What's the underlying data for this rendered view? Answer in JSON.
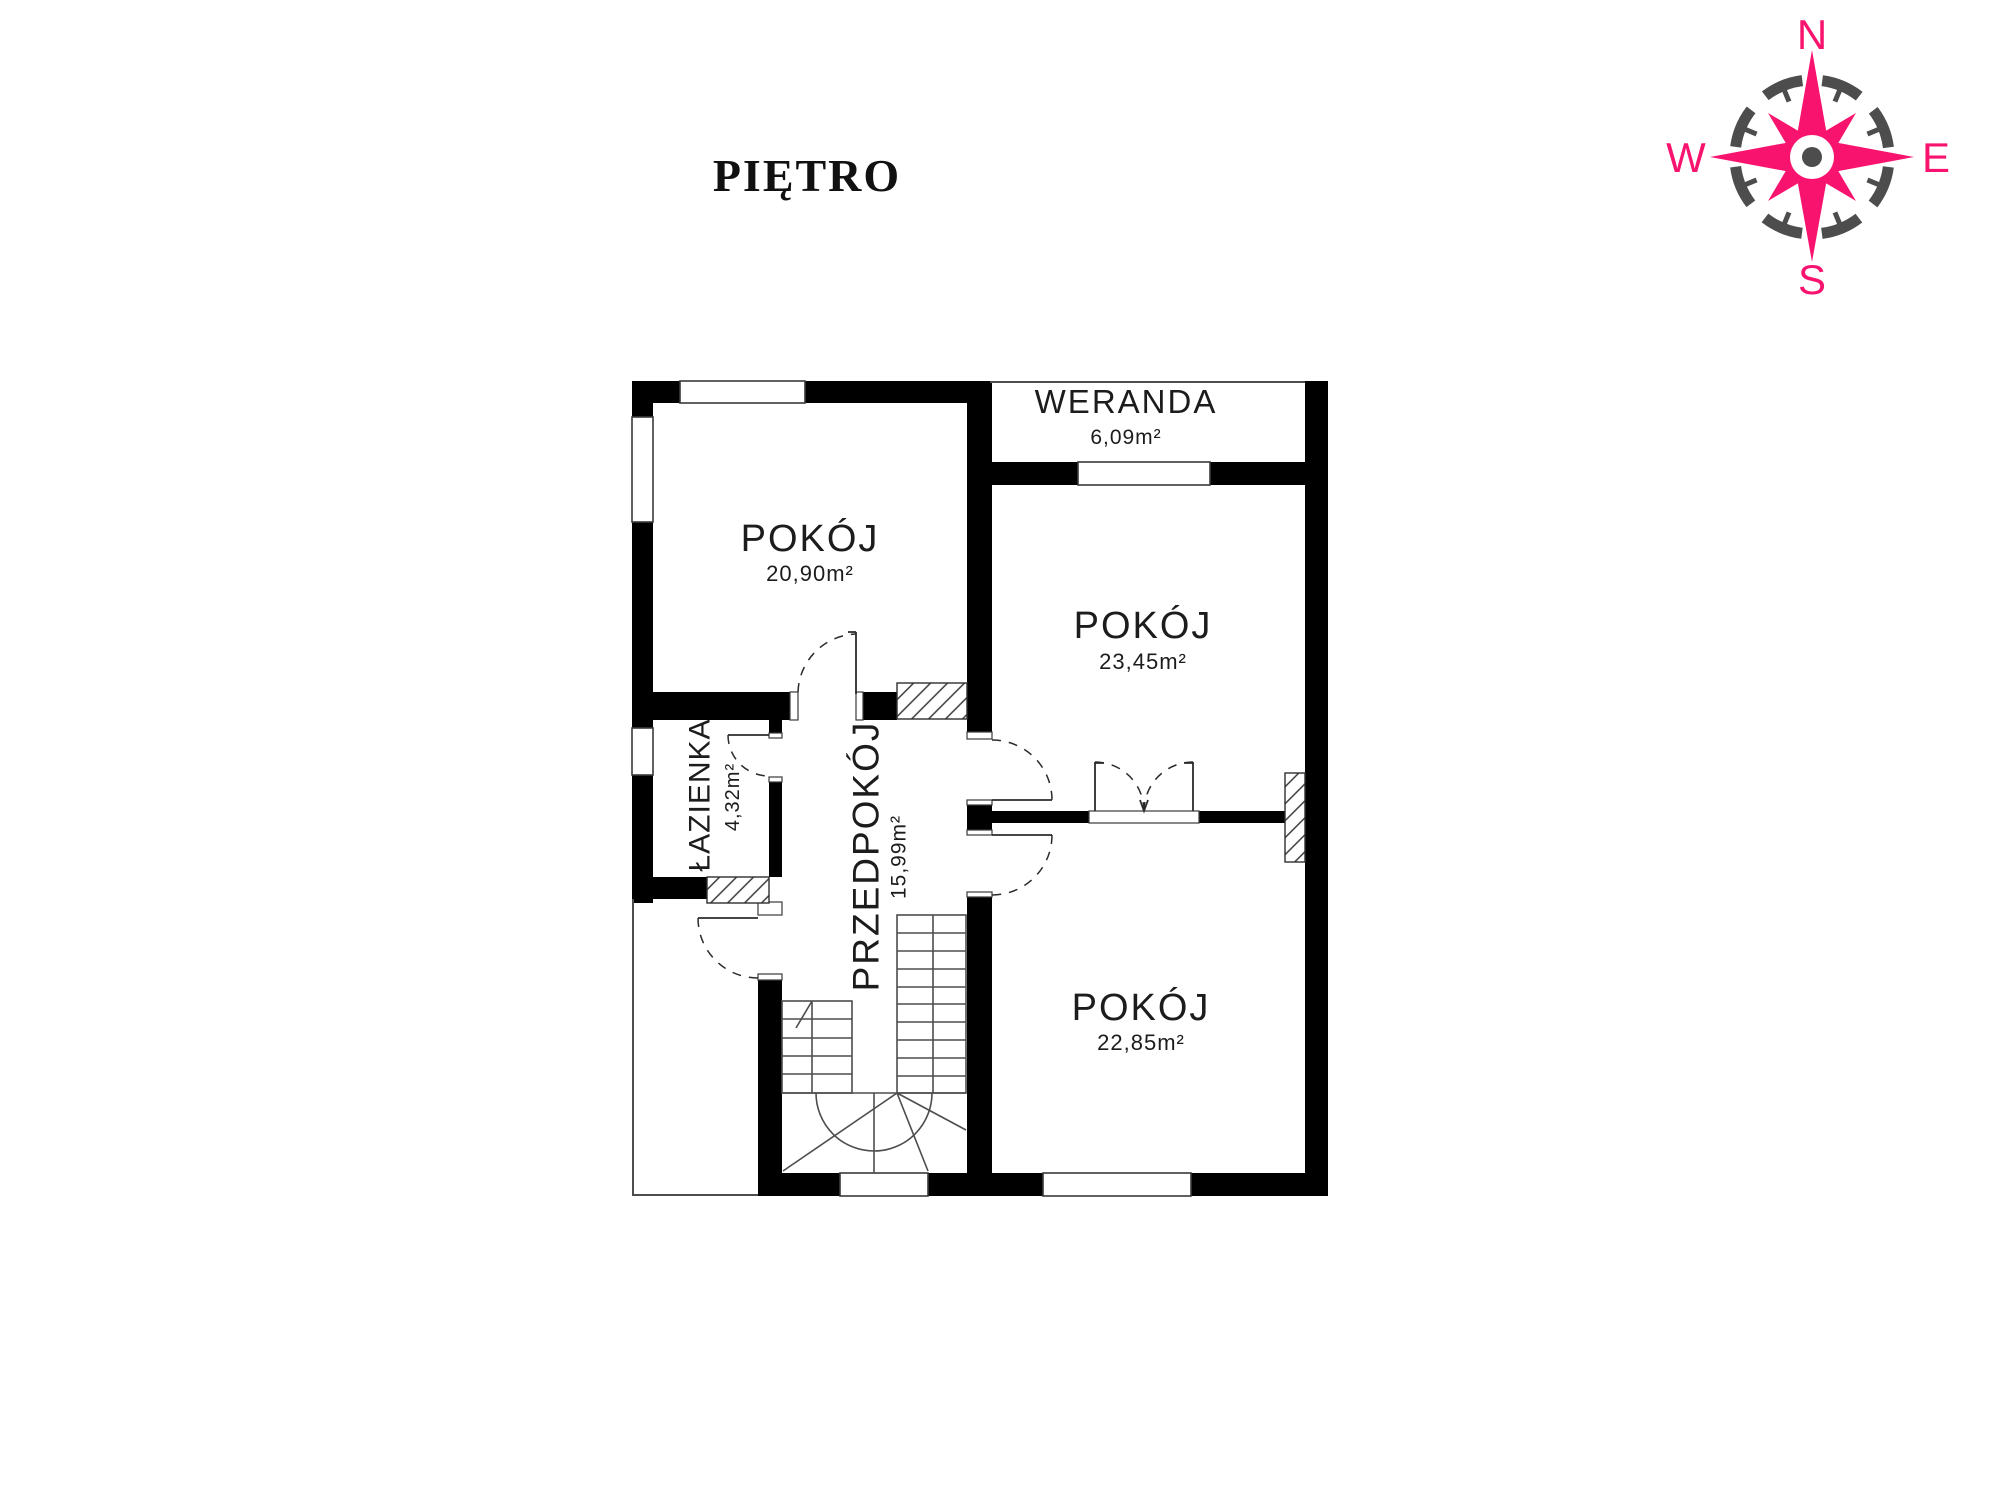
{
  "title": "PIĘTRO",
  "compass": {
    "north": "N",
    "east": "E",
    "south": "S",
    "west": "W",
    "accent_color": "#f8146e",
    "ring_color": "#4d4d4d"
  },
  "rooms": [
    {
      "id": "pokoj-top-left",
      "name": "POKÓJ",
      "area": "20,90m²"
    },
    {
      "id": "weranda",
      "name": "WERANDA",
      "area": "6,09m²"
    },
    {
      "id": "pokoj-right",
      "name": "POKÓJ",
      "area": "23,45m²"
    },
    {
      "id": "lazienka",
      "name": "ŁAZIENKA",
      "area": "4,32m²"
    },
    {
      "id": "przedpokoj",
      "name": "PRZEDPOKÓJ",
      "area": "15,99m²"
    },
    {
      "id": "pokoj-bottom-right",
      "name": "POKÓJ",
      "area": "22,85m²"
    }
  ],
  "colors": {
    "walls": "#000000",
    "background": "#ffffff",
    "lines": "#4d4d4d",
    "text": "#1c1c1c"
  }
}
